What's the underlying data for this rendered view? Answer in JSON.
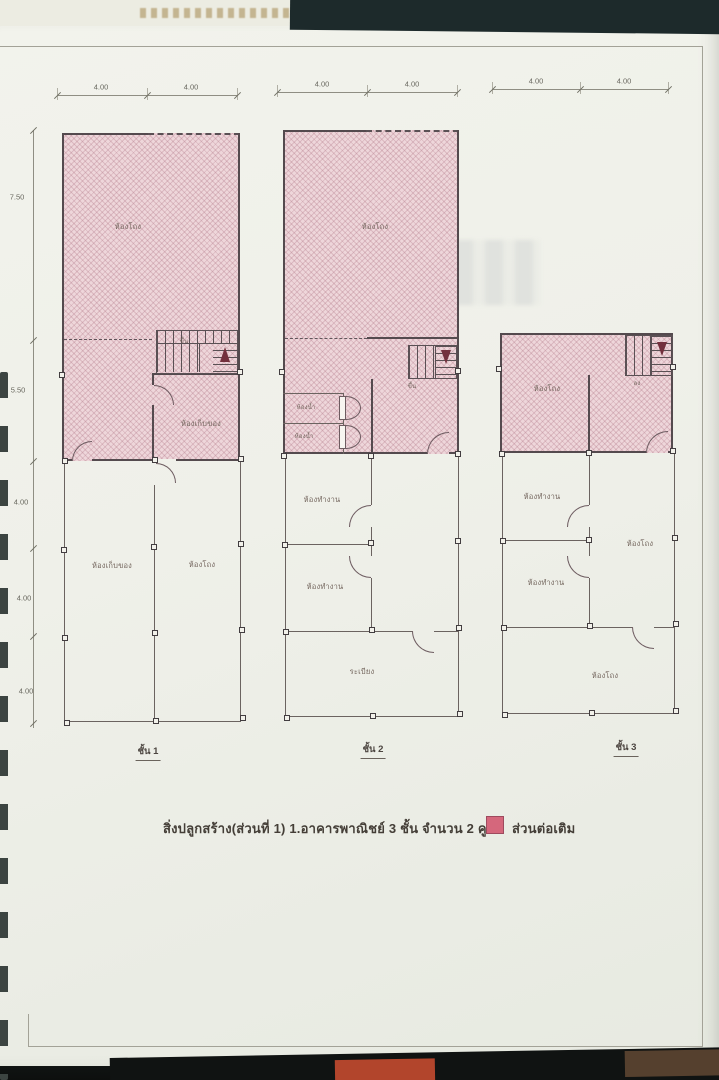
{
  "photo": {
    "caption": "สิ่งปลูกสร้าง(ส่วนที่ 1) 1.อาคารพาณิชย์ 3 ชั้น จำนวน 2 คูหา",
    "legend": {
      "label": "ส่วนต่อเติม",
      "swatch_color": "#d5677c"
    }
  },
  "dimensions": {
    "left_chain": [
      "7.50",
      "5.50",
      "4.00",
      "4.00",
      "4.00"
    ],
    "plan1_top": [
      "4.00",
      "4.00"
    ],
    "plan2_top": [
      "4.00",
      "4.00"
    ],
    "plan3_top": [
      "4.00",
      "4.00"
    ]
  },
  "plans": [
    {
      "floor_label": "ชั้น 1",
      "stair_label": "ขึ้น",
      "rooms": {
        "hall_upper": "ห้องโถง",
        "storage_pink": "ห้องเก็บของ",
        "storage": "ห้องเก็บของ",
        "hall": "ห้องโถง"
      }
    },
    {
      "floor_label": "ชั้น 2",
      "stair_label": "ขึ้น",
      "rooms": {
        "hall_upper": "ห้องโถง",
        "bath_1": "ห้องน้ำ",
        "bath_2": "ห้องน้ำ",
        "office_1": "ห้องทำงาน",
        "office_2": "ห้องทำงาน",
        "balcony": "ระเบียง"
      }
    },
    {
      "floor_label": "ชั้น 3",
      "stair_label": "ลง",
      "rooms": {
        "hall_upper": "ห้องโถง",
        "office_1": "ห้องทำงาน",
        "hall_mid": "ห้องโถง",
        "office_2": "ห้องทำงาน",
        "hall_lower": "ห้องโถง"
      }
    }
  ]
}
